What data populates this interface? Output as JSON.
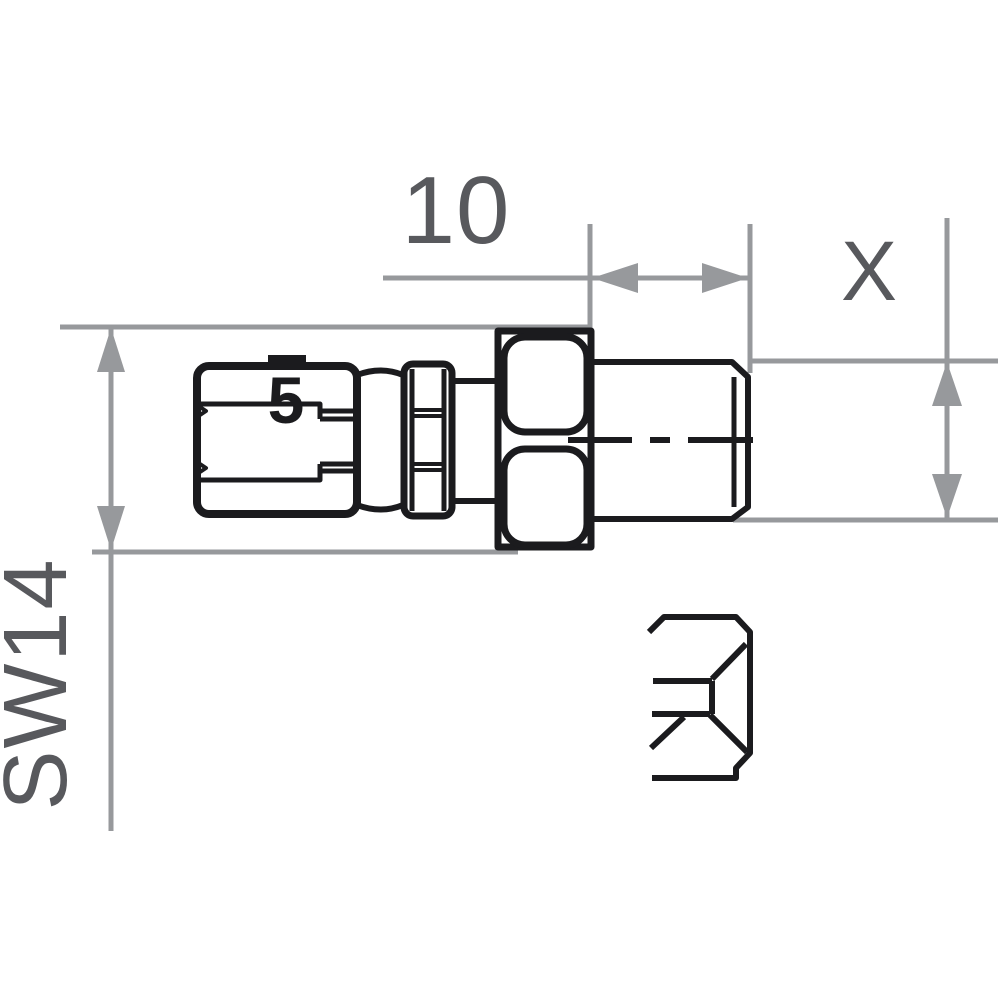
{
  "drawing": {
    "dimension_labels": {
      "width": "10",
      "thread": "X",
      "hex_wrench": "SW14"
    },
    "part_markings": {
      "stamp": "5"
    },
    "colors": {
      "background": "#ffffff",
      "part_line": "#1b1b1e",
      "dim_line": "#97999c",
      "dim_text": "#58595d"
    }
  }
}
